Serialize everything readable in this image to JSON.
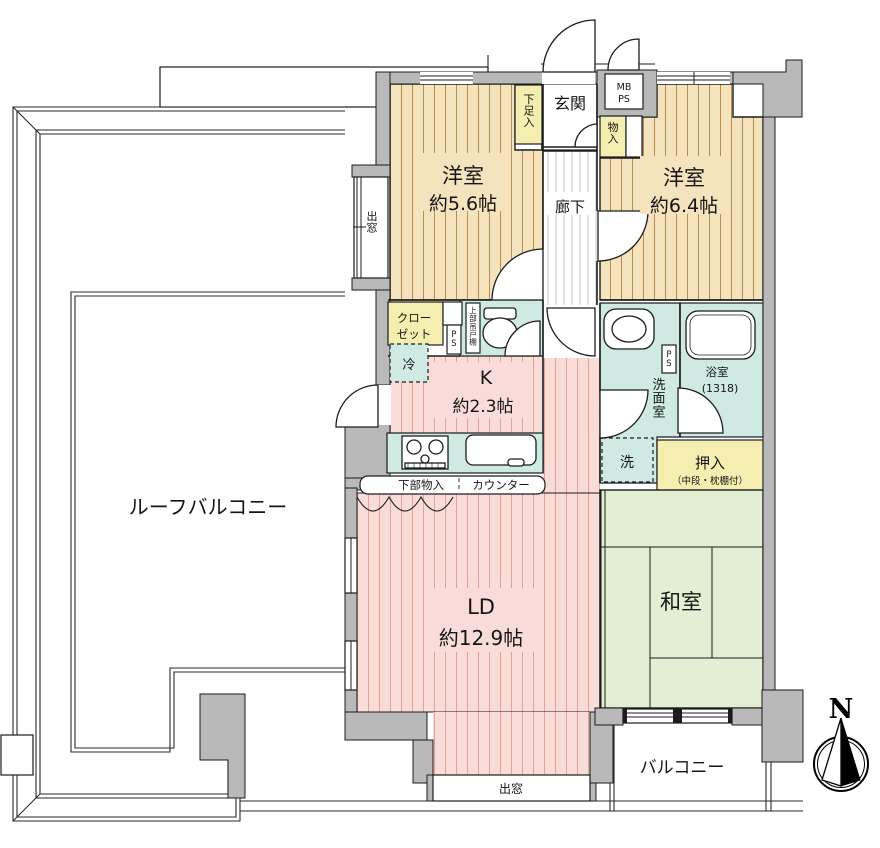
{
  "colors": {
    "wall_gray": "#b9b9b9",
    "wood_floor": "#f4e3bc",
    "wood_stripe": "#b68e52",
    "ld_pink": "#f9dcd8",
    "ld_stripe": "#e0a29b",
    "water_cyan": "#cfeae3",
    "closet_yellow": "#f4eeb0",
    "tatami_green": "#e3efd2",
    "outline": "#1c1c1c"
  },
  "rooms": {
    "west_room_1": {
      "name": "洋室",
      "size": "約5.6帖"
    },
    "west_room_2": {
      "name": "洋室",
      "size": "約6.4帖"
    },
    "living_dining": {
      "name": "LD",
      "size": "約12.9帖"
    },
    "kitchen": {
      "name": "K",
      "size": "約2.3帖"
    },
    "japanese_room": {
      "name": "和室"
    },
    "entrance": {
      "name": "玄関"
    },
    "hallway": {
      "name": "廊下"
    },
    "washroom": {
      "name": "洗面室"
    },
    "bathroom": {
      "name": "浴室",
      "size": "(1318)"
    },
    "roof_balcony": {
      "name": "ルーフバルコニー"
    },
    "balcony": {
      "name": "バルコニー"
    }
  },
  "features": {
    "shoe_cabinet": "下足入",
    "storage": "物入",
    "closet_line1": "クロー",
    "closet_line2": "ゼット",
    "oshiire": "押入",
    "oshiire_note": "（中段・枕棚付）",
    "refrigerator": "冷",
    "washer": "洗",
    "bay_window_left": "出窓",
    "bay_window_bottom": "出窓",
    "meter_box_line1": "MB",
    "meter_box_line2": "PS",
    "pipe_space_1": "PS",
    "pipe_space_2": "PS",
    "upper_cabinet": "上部吊戸棚",
    "under_counter_storage": "下部物入",
    "counter": "カウンター"
  },
  "compass": {
    "label": "N"
  }
}
